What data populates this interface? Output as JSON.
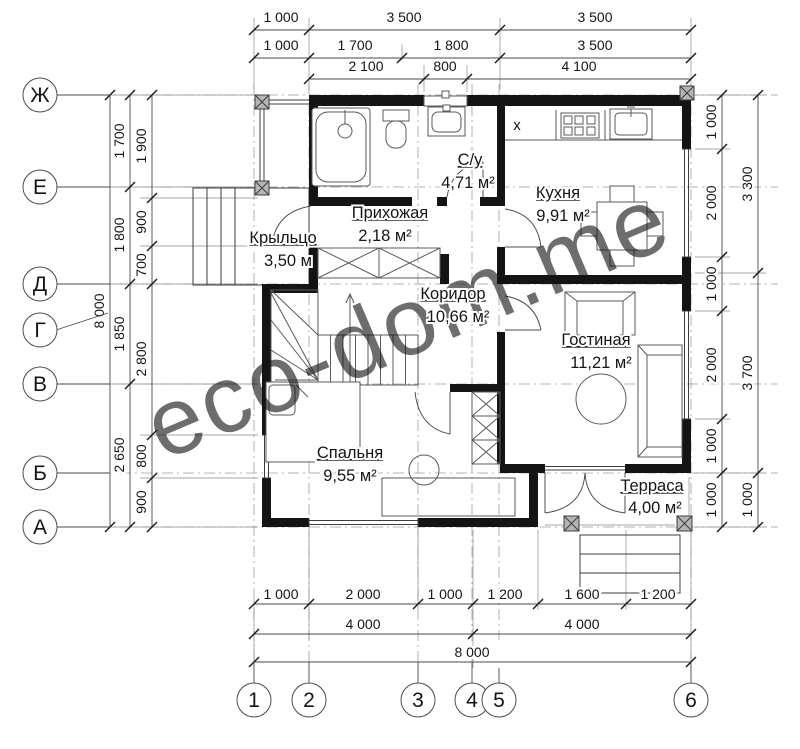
{
  "title": "План 1 этажа",
  "watermark": {
    "text": "eco-dom.me",
    "color": "#edead0"
  },
  "marker": {
    "symbol": "x",
    "color": "#29abe2"
  },
  "axes": {
    "rows": [
      "Ж",
      "Е",
      "Д",
      "Г",
      "В",
      "Б",
      "А"
    ],
    "cols": [
      "1",
      "2",
      "3",
      "4",
      "5",
      "6"
    ]
  },
  "dims": {
    "top1": [
      "1 000",
      "3 500",
      "3 500"
    ],
    "top2": [
      "1 000",
      "1 700",
      "1 800",
      "3 500"
    ],
    "top3": [
      "2 100",
      "800",
      "4 100"
    ],
    "bottom1": [
      "1 000",
      "2 000",
      "1 000",
      "1 200",
      "1 600",
      "1 200"
    ],
    "bottom2": [
      "4 000",
      "4 000"
    ],
    "bottom3": [
      "8 000"
    ],
    "left_total": "8 000",
    "left_mid": [
      "1 700",
      "1 800",
      "1 850",
      "2 650"
    ],
    "left_inner": [
      "1 900",
      "900",
      "700",
      "2 800",
      "800",
      "900"
    ],
    "right_inner": [
      "1 000",
      "2 000",
      "1 000",
      "2 000",
      "1 000",
      "1 000"
    ],
    "right_outer": [
      "3 300",
      "3 700",
      "1 000"
    ]
  },
  "rooms": {
    "su": {
      "name": "С/у",
      "area": "4,71 м²"
    },
    "kitchen": {
      "name": "Кухня",
      "area": "9,91 м²"
    },
    "hallway": {
      "name": "Прихожая",
      "area": "2,18 м²"
    },
    "porch": {
      "name": "Крыльцо",
      "area": "3,50 м"
    },
    "corridor": {
      "name": "Коридор",
      "area": "10,66 м²"
    },
    "living": {
      "name": "Гостиная",
      "area": "11,21 м²"
    },
    "bedroom": {
      "name": "Спальня",
      "area": "9,55 м²"
    },
    "terrace": {
      "name": "Терраса",
      "area": "4,00 м²"
    }
  }
}
